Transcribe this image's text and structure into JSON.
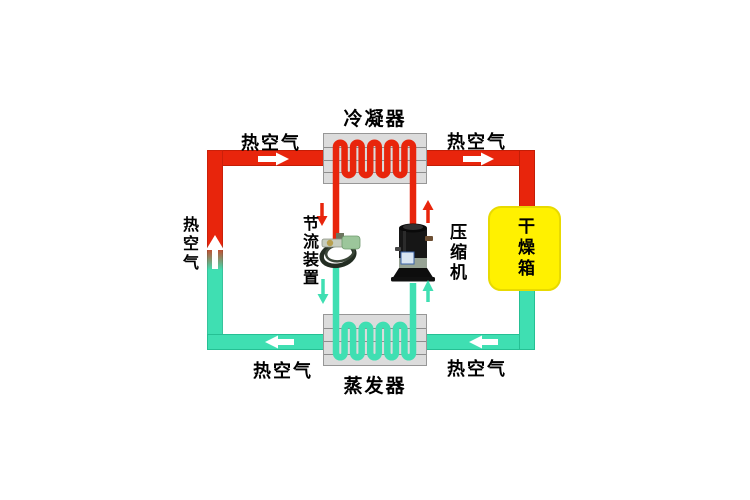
{
  "diagram": {
    "type": "heat-pump-drying-cycle",
    "labels": {
      "condenser": "冷凝器",
      "evaporator": "蒸发器",
      "compressor": "压缩机",
      "throttle_device": "节流装置",
      "drying_box": "干燥箱",
      "hot_air_top_left": "热空气",
      "hot_air_top_right": "热空气",
      "hot_air_bottom_left": "热空气",
      "hot_air_bottom_right": "热空气",
      "hot_air_left_side": "热空气"
    },
    "colors": {
      "hot_air_pipe": "#e8250c",
      "cold_air_pipe": "#3fdfb2",
      "drying_box_fill": "#fff100",
      "exchanger_box_fill": "#dcdcdc",
      "flow_arrow": "#ffffff",
      "background": "#ffffff",
      "text": "#000000"
    },
    "flow_arrows": [
      "hot-air-right-top-left",
      "hot-air-right-top-right",
      "hot-air-left-bottom-left",
      "hot-air-left-bottom-right",
      "hot-air-up-left-pipe",
      "refrigerant-down-to-throttle",
      "refrigerant-up-from-compressor",
      "refrigerant-down-to-evaporator",
      "refrigerant-up-to-compressor"
    ]
  }
}
